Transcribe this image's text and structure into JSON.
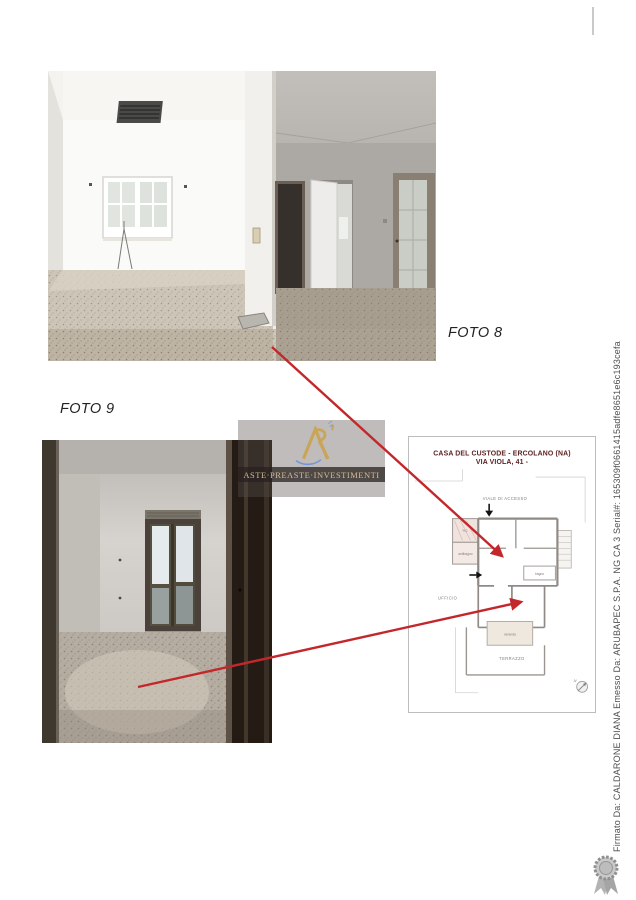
{
  "photo_labels": {
    "foto8": "FOTO 8",
    "foto9": "FOTO 9"
  },
  "floorplan": {
    "title_line1": "CASA DEL CUSTODE - ERCOLANO (NA)",
    "title_line2": "VIA VIOLA, 41 -",
    "rooms": {
      "viale_di_accesso": "VIALE DI ACCESSO",
      "wc": "w.c.",
      "antibagno": "antibagno",
      "bagno": "bagno",
      "ufficio": "UFFICIO",
      "veranda": "veranda",
      "terrazzo": "TERRAZZO",
      "north": "N"
    }
  },
  "watermark": {
    "brand_text": "ASTE·PREASTE·INVESTIMENTI"
  },
  "signature": {
    "vertical_text": "Firmato Da: CALDARONE DIANA Emesso Da: ARUBAPEC S.P.A. NG CA 3 Serial#: 165309f0661415adfe8651e6c193cefa"
  },
  "colors": {
    "arrow_red": "#c3272b",
    "plan_title": "#5c2222",
    "watermark_gold": "#d3bd92"
  }
}
